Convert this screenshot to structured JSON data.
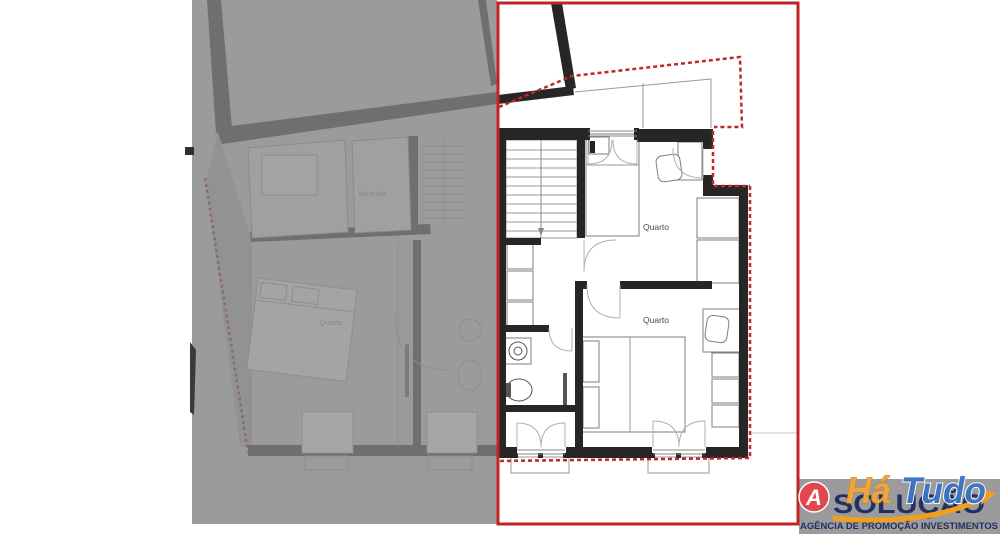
{
  "plan": {
    "active": {
      "room1_label": "Quarto",
      "room2_label": "Quarto"
    },
    "faded": {
      "balcony_label": "Varanda",
      "bedroom_label": "Quarto"
    }
  },
  "logo": {
    "monogram": "A",
    "brand": "SOLUÇÃO",
    "tagline": "AGÊNCIA DE PROMOÇÃO INVESTIMENTOS",
    "watermark_part1": "Há",
    "watermark_part2": "Tudo"
  },
  "colors": {
    "highlight_border": "#bf2420",
    "boundary_dashed": "#c1272d",
    "wall": "#262626",
    "faded_background": "#9b9b9b",
    "faded_wall": "#6f6f6f",
    "logo_navy": "#232f63",
    "logo_red": "#e0474e",
    "logo_orange": "#f49f1c",
    "watermark_orange": "#f2a63a",
    "watermark_blue": "#3873c4"
  }
}
